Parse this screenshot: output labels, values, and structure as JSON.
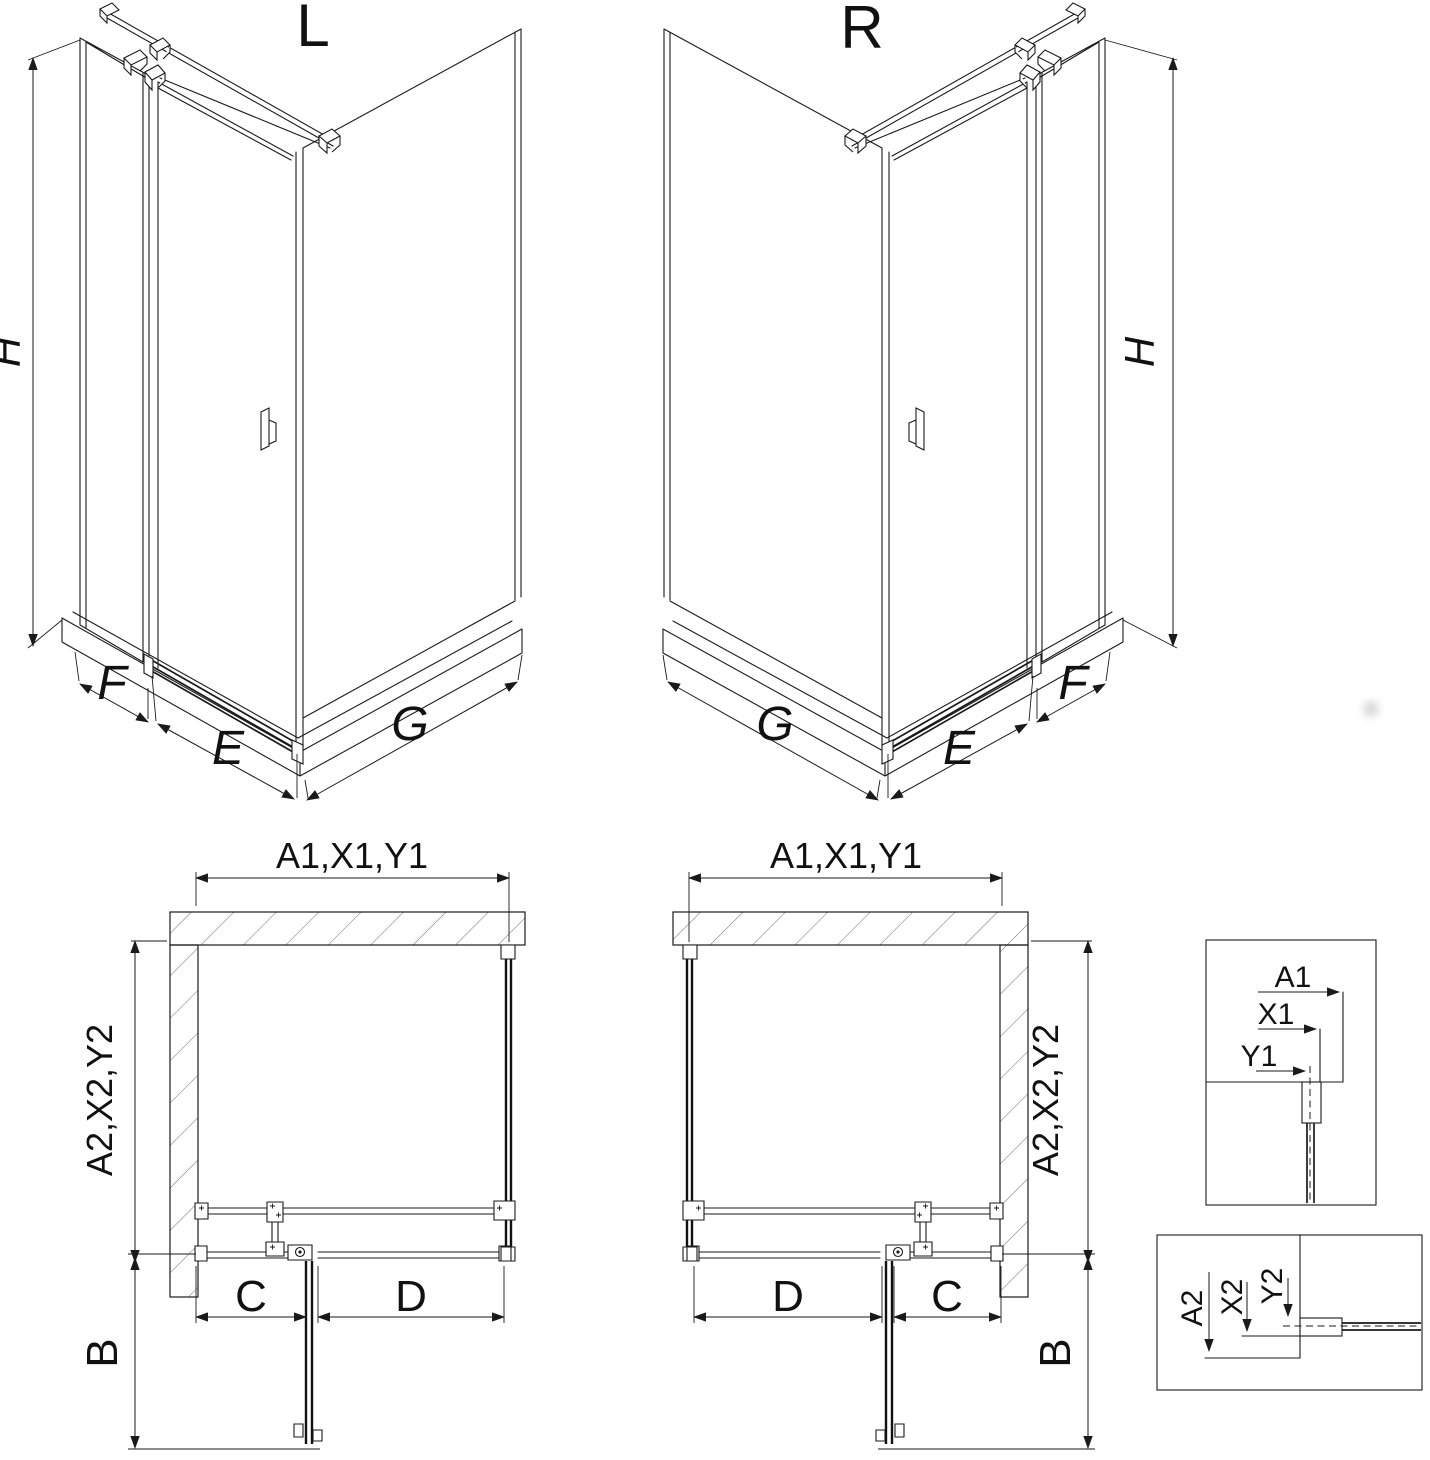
{
  "drawing": {
    "type": "shower-enclosure-installation-diagram",
    "variant_left": "L",
    "variant_right": "R",
    "iso_dims": {
      "height": "H",
      "side_panel_width": "F",
      "door_segment_width": "E",
      "wall_segment_width": "G"
    },
    "plan_dims": {
      "top_group": "A1,X1,Y1",
      "side_group": "A2,X2,Y2",
      "door_swing": "B",
      "fixed_section": "C",
      "opening_section": "D"
    },
    "detail_top": {
      "a1": "A1",
      "x1": "X1",
      "y1": "Y1"
    },
    "detail_bottom": {
      "a2": "A2",
      "x2": "X2",
      "y2": "Y2"
    },
    "colors": {
      "line": "#1a1a1a",
      "hatch": "#7a7a7a",
      "watermark": "#d9d9d9",
      "background": "#ffffff"
    }
  }
}
